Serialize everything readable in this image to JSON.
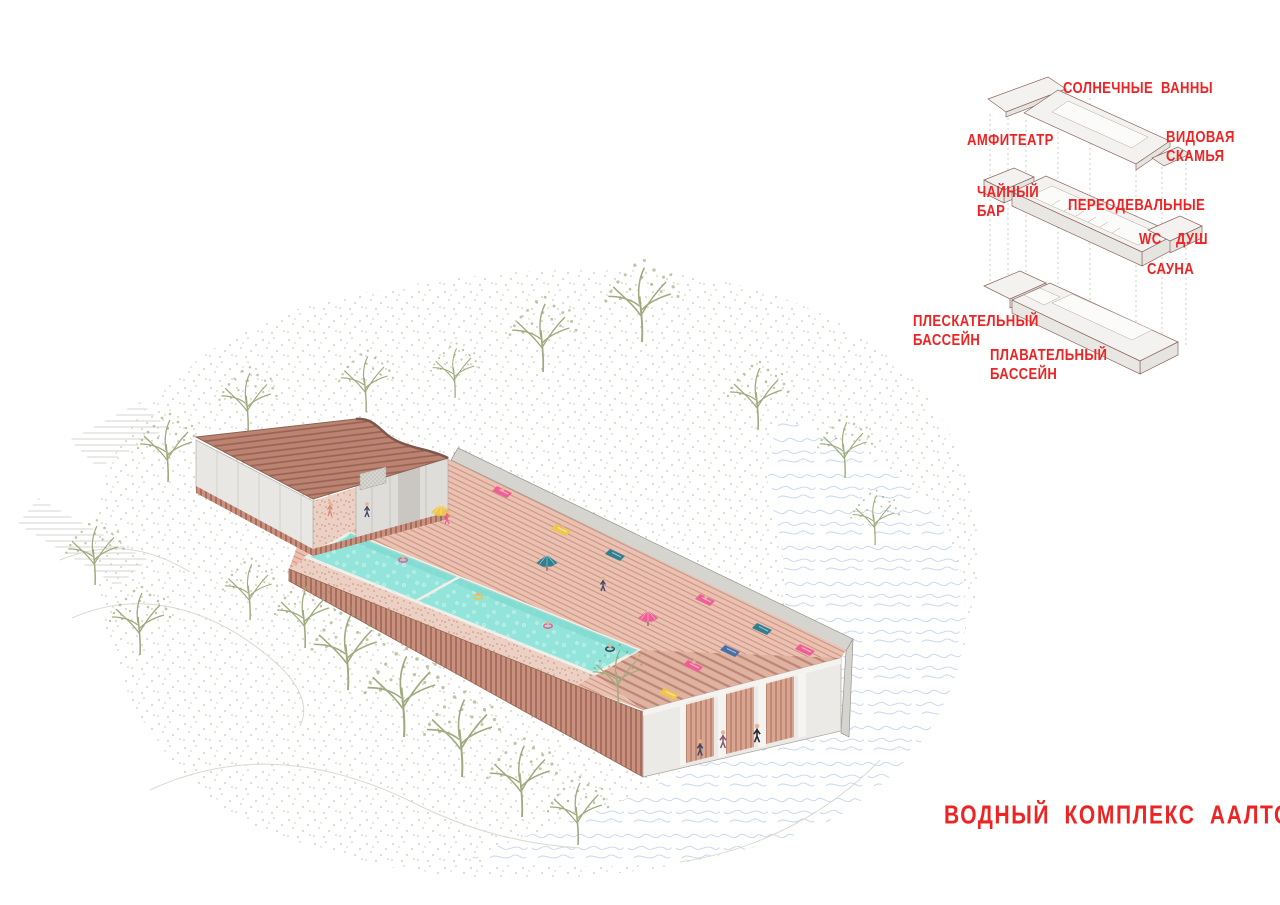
{
  "title": "ВОДНЫЙ КОМПЛЕКС ААЛТО",
  "annotations": [
    {
      "id": "sun-baths",
      "lines": [
        "СОЛНЕЧНЫЕ ВАННЫ"
      ],
      "x": 1063,
      "y": 79
    },
    {
      "id": "amphitheater",
      "lines": [
        "АМФИТЕАТР"
      ],
      "x": 967,
      "y": 131
    },
    {
      "id": "view-bench",
      "lines": [
        "ВИДОВАЯ",
        "СКАМЬЯ"
      ],
      "x": 1166,
      "y": 128
    },
    {
      "id": "tea-bar",
      "lines": [
        "ЧАЙНЫЙ",
        "БАР"
      ],
      "x": 977,
      "y": 183
    },
    {
      "id": "changing-rooms",
      "lines": [
        "ПЕРЕОДЕВАЛЬНЫЕ"
      ],
      "x": 1068,
      "y": 196
    },
    {
      "id": "wc",
      "lines": [
        "WC"
      ],
      "x": 1139,
      "y": 230
    },
    {
      "id": "shower",
      "lines": [
        "ДУШ"
      ],
      "x": 1176,
      "y": 230
    },
    {
      "id": "sauna",
      "lines": [
        "САУНА"
      ],
      "x": 1147,
      "y": 260
    },
    {
      "id": "splash-pool",
      "lines": [
        "ПЛЕСКАТЕЛЬНЫЙ",
        "БАССЕЙН"
      ],
      "x": 913,
      "y": 312
    },
    {
      "id": "swimming-pool",
      "lines": [
        "ПЛАВАТЕЛЬНЫЙ",
        "БАССЕЙН"
      ],
      "x": 990,
      "y": 346
    }
  ],
  "colors": {
    "label_red": "#ee2424",
    "roof_terracotta": "#bb8472",
    "deck_pink": "#e9c2b2",
    "pool_turquoise": "#93e4da",
    "tree_olive": "#9fab7e",
    "lake_blue": "#c5d6ee"
  }
}
